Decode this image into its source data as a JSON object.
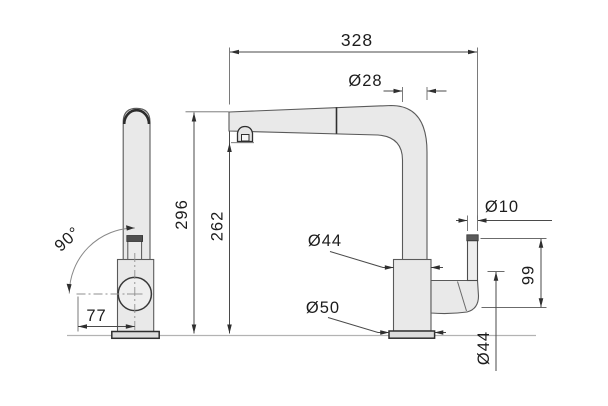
{
  "drawing": {
    "type": "technical-dimension-drawing",
    "subject": "kitchen pull-out faucet, front and side orthographic views",
    "labels": {
      "overall_width": "328",
      "spout_tube_diameter": "Ø28",
      "total_height": "296",
      "spout_clearance_height": "262",
      "body_diameter": "Ø44",
      "base_diameter": "Ø50",
      "lever_rod_diameter": "Ø10",
      "handle_zone_height": "99",
      "handle_diameter": "Ø44",
      "swivel_angle": "90°",
      "handle_reach": "77"
    },
    "colors": {
      "background": "#ffffff",
      "part_fill": "#e9e9e9",
      "part_outline": "#4d4d4d",
      "accent_outline": "#2f2f2f",
      "dimension_line": "#4a4a4a",
      "centerline": "#8f8f8f",
      "ground_line": "#b3b3b3",
      "text": "#1c1c1c"
    }
  }
}
